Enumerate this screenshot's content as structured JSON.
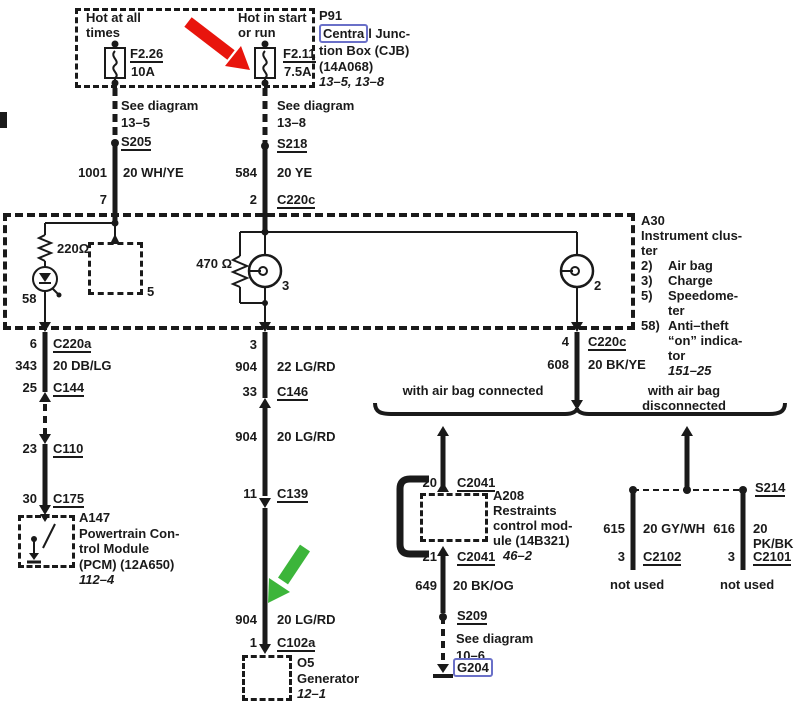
{
  "colors": {
    "wire": "#1a1a1a",
    "link_box": "#6a70c8",
    "red_arrow": "#e8150d",
    "green_arrow": "#3cb53a"
  },
  "fusebox": {
    "id": "P91",
    "name_hl": "Centra",
    "name_rest": "l Junc-",
    "name_l2": "tion Box (CJB)",
    "name_l3": "(14A068)",
    "pages": "13–5, 13–8",
    "fuse1_hot": "Hot at all\ntimes",
    "fuse1_name": "F2.26",
    "fuse1_rating": "10A",
    "fuse2_hot": "Hot in start\nor run",
    "fuse2_name": "F2.11",
    "fuse2_rating": "7.5A"
  },
  "feed_left": {
    "see": "See diagram\n13–5",
    "splice": "S205",
    "circuit": "1001",
    "gauge": "20 WH/YE",
    "pin": "7"
  },
  "feed_right": {
    "see": "See diagram\n13–8",
    "splice": "S218",
    "circuit": "584",
    "gauge": "20 YE",
    "pin": "2",
    "conn": "C220c"
  },
  "cluster": {
    "id": "A30",
    "name": "Instrument clus-\nter",
    "legend": [
      {
        "n": "2)",
        "t": "Air bag"
      },
      {
        "n": "3)",
        "t": "Charge"
      },
      {
        "n": "5)",
        "t": "Speedome-\nter"
      },
      {
        "n": "58)",
        "t": "Anti–theft\n“on” indica-\ntor"
      }
    ],
    "pages": "151–25",
    "res1": "220Ω",
    "res2": "470 Ω",
    "bulb3": "3",
    "bulb2": "2",
    "box5": "5",
    "led58": "58"
  },
  "col1": {
    "pin6": "6",
    "conn6": "C220a",
    "circ": "343",
    "gauge": "20 DB/LG",
    "pin25": "25",
    "conn25": "C144",
    "pin23": "23",
    "conn23": "C110",
    "pin30": "30",
    "conn30": "C175"
  },
  "pcm": {
    "id": "A147",
    "l1": "Powertrain Con-",
    "l2": "trol Module",
    "l3": "(PCM) (12A650)",
    "pages": "112–4"
  },
  "col2": {
    "pin3": "3",
    "circ_a": "904",
    "gauge_a": "22 LG/RD",
    "pin33": "33",
    "conn33": "C146",
    "circ_b": "904",
    "gauge_b": "20 LG/RD",
    "pin11": "11",
    "conn11": "C139",
    "circ_c": "904",
    "gauge_c": "20 LG/RD",
    "pin1": "1",
    "conn1": "C102a"
  },
  "gen": {
    "id": "O5",
    "name": "Generator",
    "pages": "12–1"
  },
  "col3": {
    "pin4": "4",
    "conn4": "C220c",
    "circ": "608",
    "gauge": "20 BK/YE"
  },
  "branch": {
    "left_label": "with air bag connected",
    "right_label": "with air bag disconnected"
  },
  "a208": {
    "pin20": "20",
    "conn20": "C2041",
    "id": "A208",
    "l1": "Restraints",
    "l2": "control mod-",
    "l3": "ule (14B321)",
    "pages": "46–2",
    "pin21": "21",
    "conn21": "C2041",
    "circ": "649",
    "gauge": "20 BK/OG",
    "splice": "S209",
    "see": "See diagram\n10–6",
    "ground": "G204"
  },
  "s214": {
    "splice": "S214",
    "left": {
      "circ": "615",
      "gauge": "20 GY/WH",
      "pin": "3",
      "conn": "C2102",
      "note": "not used"
    },
    "right": {
      "circ": "616",
      "gauge": "20 PK/BK",
      "pin": "3",
      "conn": "C2101",
      "note": "not used"
    }
  }
}
